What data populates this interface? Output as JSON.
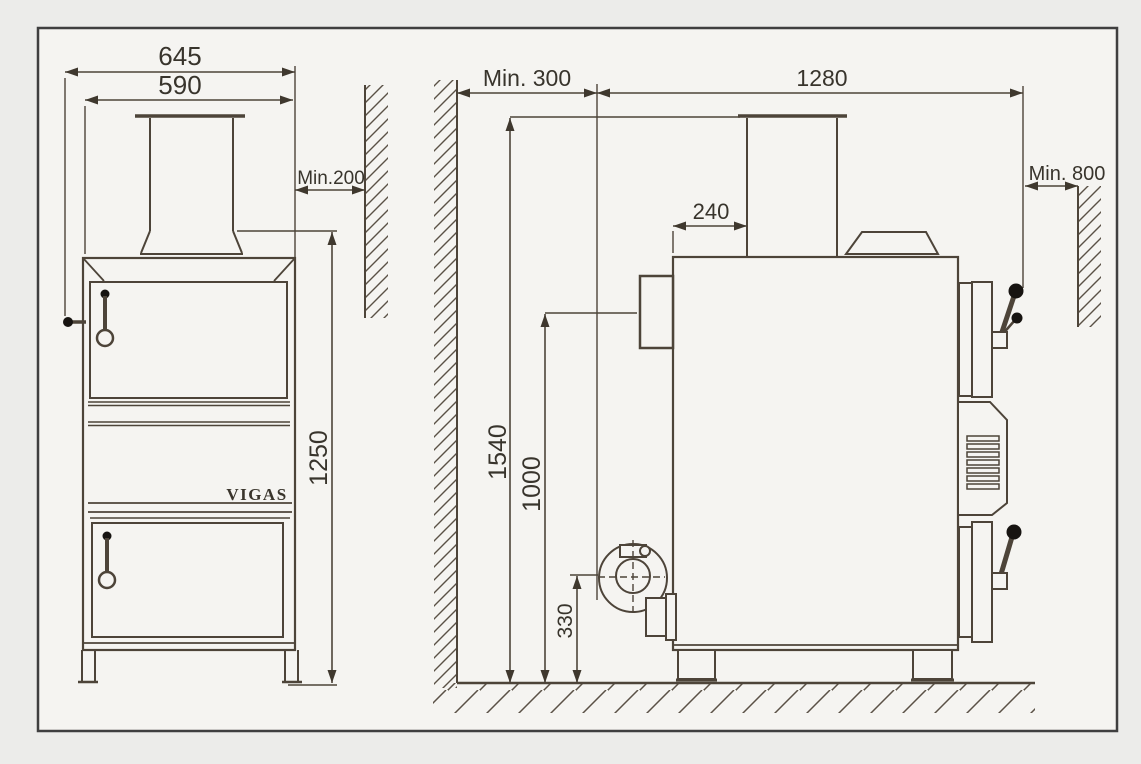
{
  "diagram": {
    "title": "VIGAS boiler installation dimensions",
    "brand_label": "VIGAS",
    "front_view": {
      "dim_overall_width": "645",
      "dim_body_width": "590",
      "dim_wall_clearance": "Min.200",
      "dim_body_height": "1250"
    },
    "side_view": {
      "dim_front_clearance": "Min. 300",
      "dim_overall_depth": "1280",
      "dim_chimney_offset": "240",
      "dim_rear_clearance": "Min. 800",
      "dim_total_height": "1540",
      "dim_flue_height": "1000",
      "dim_fan_height": "330"
    }
  }
}
